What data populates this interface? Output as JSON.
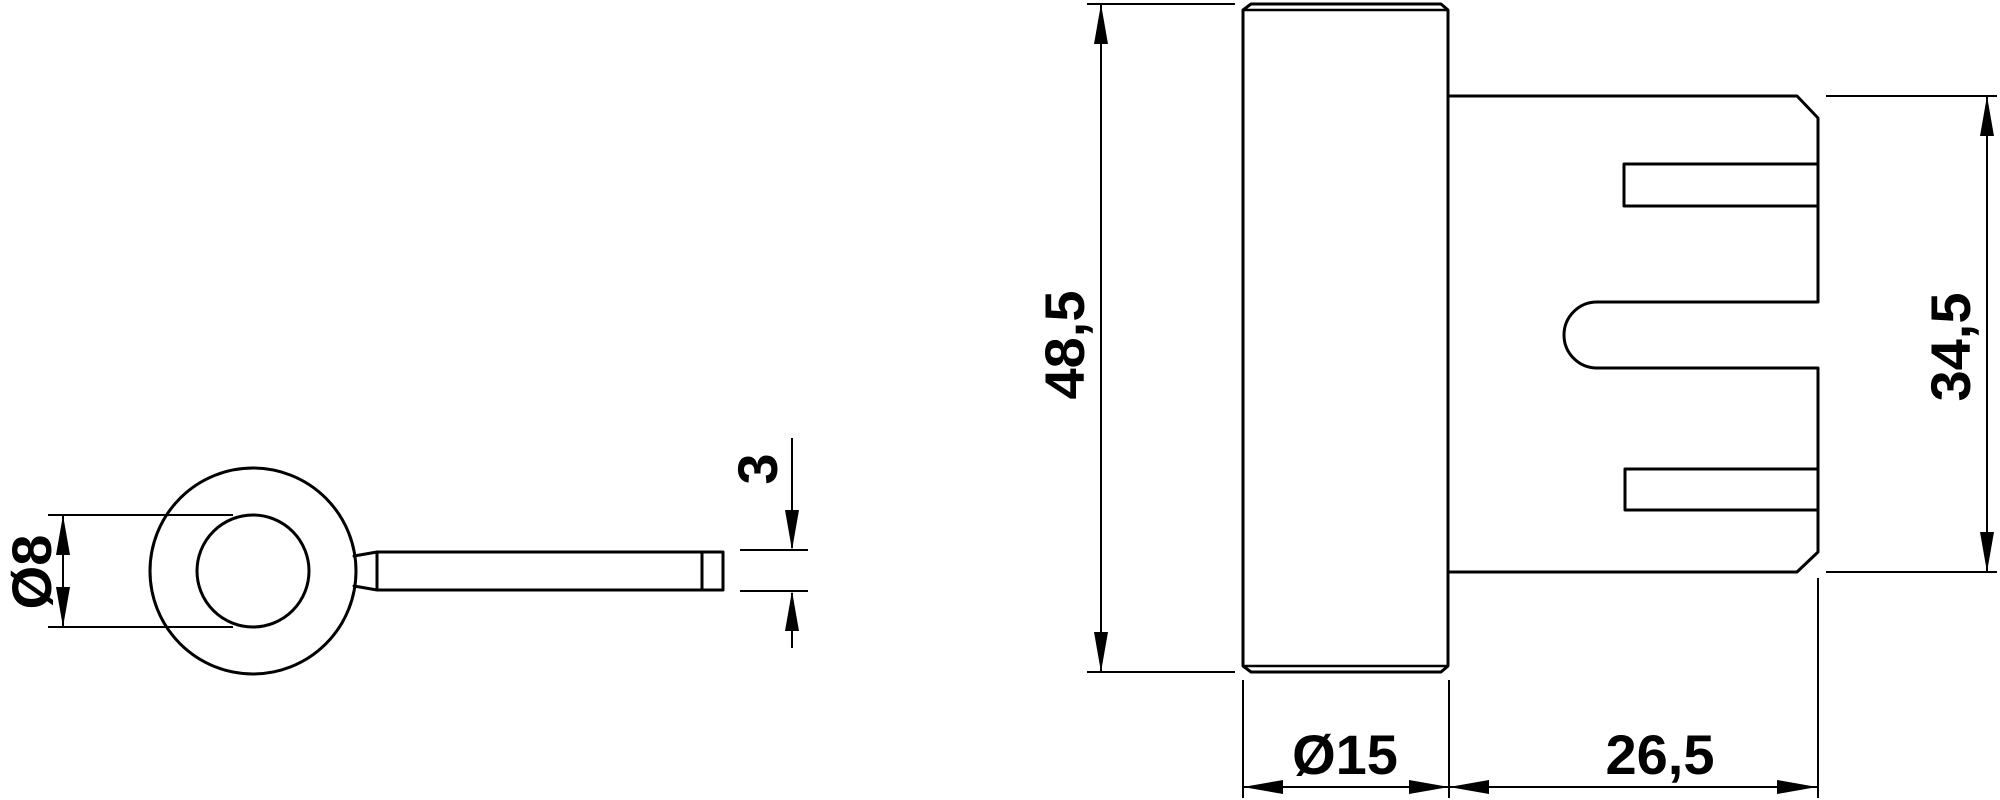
{
  "drawing": {
    "kind": "technical-dimension-drawing",
    "colors": {
      "line": "#000000",
      "background": "#ffffff"
    },
    "views": {
      "end_view": {
        "id": "end-view",
        "description": "end view: ring boss with flat lever handle"
      },
      "side_view": {
        "id": "side-view",
        "description": "side view: chamfered cylinder with slotted housing"
      }
    },
    "dimensions": {
      "ring_diameter": {
        "label": "Ø8",
        "value": 8,
        "orientation": "vertical"
      },
      "lever_thickness": {
        "label": "3",
        "value": 3,
        "orientation": "vertical"
      },
      "overall_height": {
        "label": "48,5",
        "value": 48.5,
        "orientation": "vertical"
      },
      "housing_height": {
        "label": "34,5",
        "value": 34.5,
        "orientation": "vertical"
      },
      "cylinder_diameter": {
        "label": "Ø15",
        "value": 15,
        "orientation": "horizontal"
      },
      "housing_length": {
        "label": "26,5",
        "value": 26.5,
        "orientation": "horizontal"
      }
    }
  }
}
